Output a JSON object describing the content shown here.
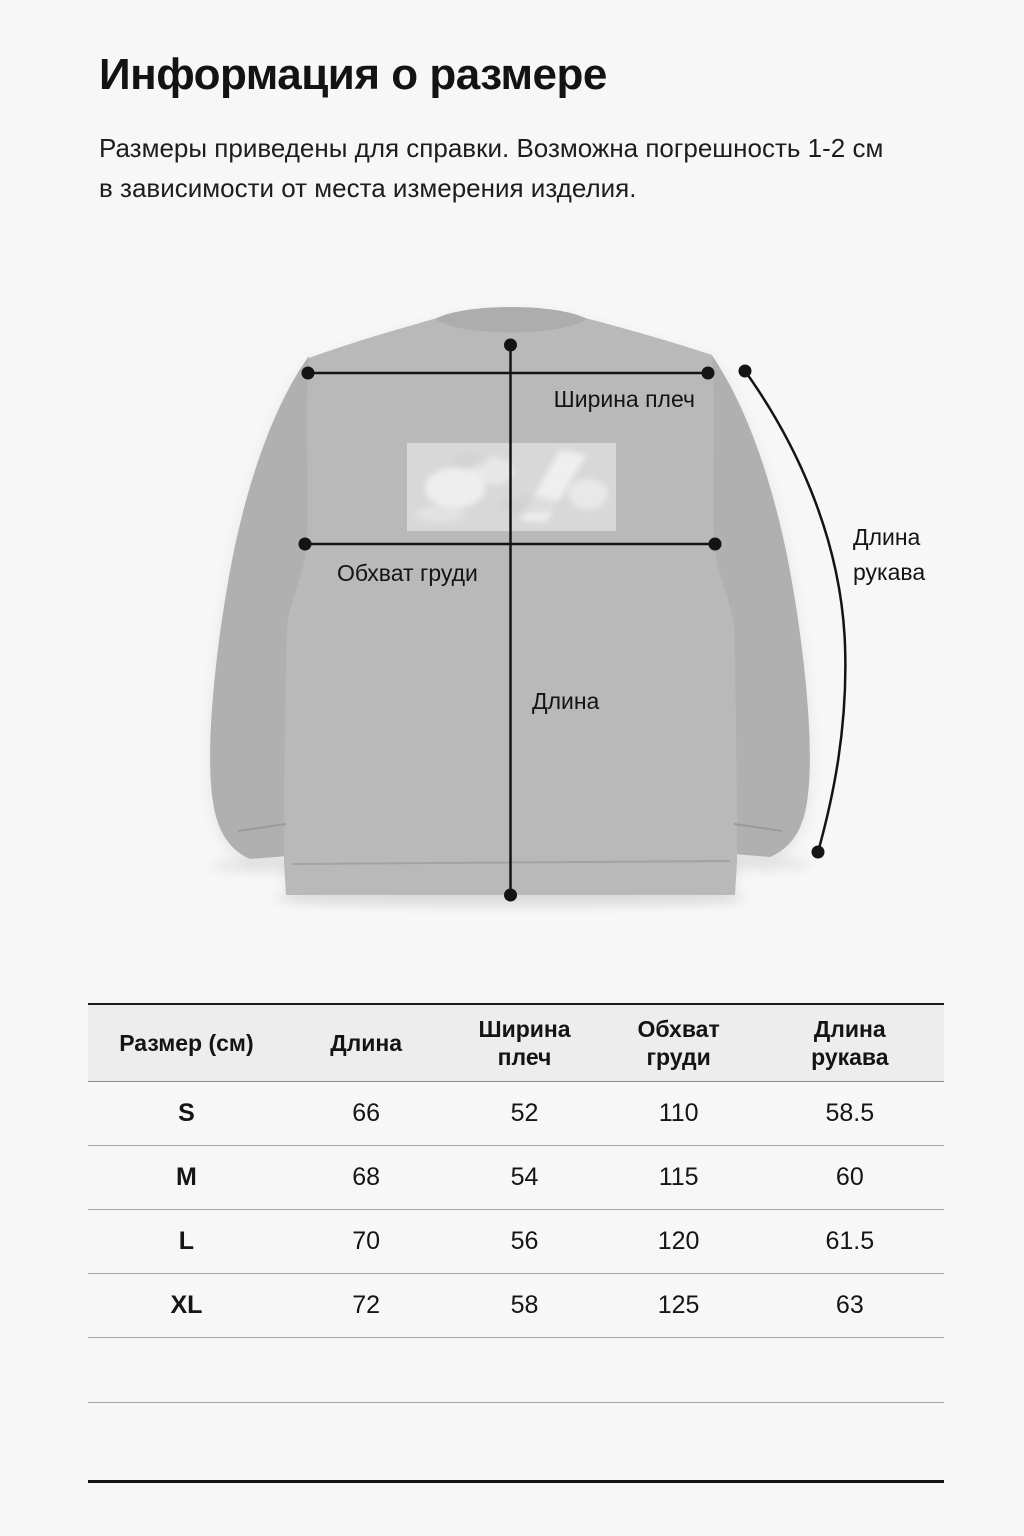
{
  "header": {
    "title": "Информация о размере",
    "subtitle_line1": "Размеры приведены для справки. Возможна погрешность 1-2 см",
    "subtitle_line2": "в зависимости от места измерения изделия."
  },
  "diagram": {
    "garment": "sweatshirt-back-view",
    "labels": {
      "shoulder_width": "Ширина плеч",
      "chest": "Обхват груди",
      "length": "Длина",
      "sleeve_line1": "Длина",
      "sleeve_line2": "рукава"
    }
  },
  "size_table": {
    "columns": [
      "Размер (см)",
      "Длина",
      "Ширина плеч",
      "Обхват груди",
      "Длина рукава"
    ],
    "rows": [
      {
        "size": "S",
        "length": "66",
        "shoulder_width": "52",
        "chest": "110",
        "sleeve_length": "58.5"
      },
      {
        "size": "M",
        "length": "68",
        "shoulder_width": "54",
        "chest": "115",
        "sleeve_length": "60"
      },
      {
        "size": "L",
        "length": "70",
        "shoulder_width": "56",
        "chest": "120",
        "sleeve_length": "61.5"
      },
      {
        "size": "XL",
        "length": "72",
        "shoulder_width": "58",
        "chest": "125",
        "sleeve_length": "63"
      }
    ]
  },
  "colors": {
    "background": "#f7f7f7",
    "text": "#161616",
    "garment_body": "#b9b9b9",
    "garment_sleeve": "#b0b0b0",
    "garment_collar": "#adadad",
    "print_patch": "#d9d9d9",
    "table_header_bg": "#ededed",
    "row_divider": "#a6a6a6",
    "table_border": "#131313",
    "annotation": "#141414"
  }
}
